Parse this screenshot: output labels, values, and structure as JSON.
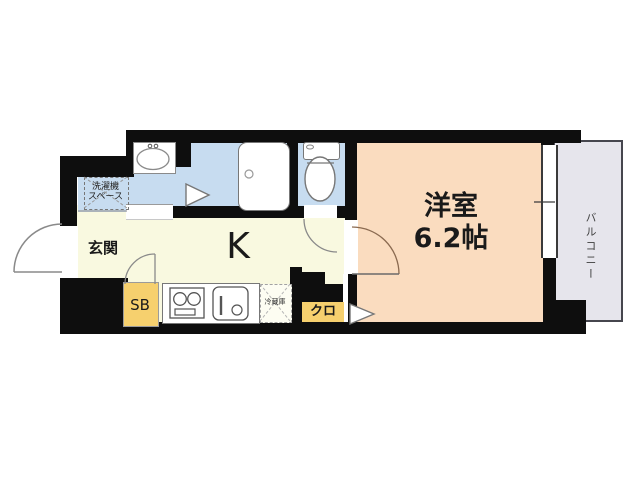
{
  "floorplan": {
    "rooms": {
      "entrance": {
        "label": "玄関"
      },
      "kitchen": {
        "label": "K"
      },
      "western_room": {
        "label": "洋室",
        "size": "6.2帖"
      },
      "balcony": {
        "label": "バルコニー"
      },
      "laundry_space": {
        "label_line1": "洗濯機",
        "label_line2": "スペース"
      },
      "shoe_box": {
        "label": "SB"
      },
      "closet": {
        "label": "クロ"
      },
      "refrigerator": {
        "label": "冷蔵庫"
      }
    },
    "colors": {
      "wall": "#0e0e0e",
      "water_area_blue": "#c7dcf0",
      "kitchen_cream": "#f9f9e0",
      "room_peach": "#fadcbf",
      "balcony_gray": "#e6e5ec",
      "storage_yellow": "#f6d06e"
    }
  }
}
